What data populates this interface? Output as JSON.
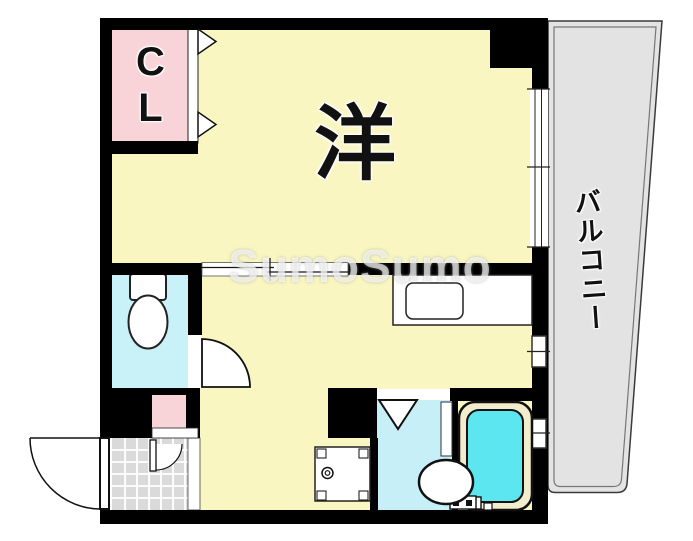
{
  "floorplan": {
    "labels": {
      "closet": "CL",
      "western_room": "洋",
      "balcony": "バルコニー"
    },
    "watermark": "SumoSumo",
    "colors": {
      "wall": "#000000",
      "room_yellow": "#FAF6C2",
      "closet_pink": "#F8D3D8",
      "toilet_cyan": "#C9F1F8",
      "washroom_cyan": "#C6EFF8",
      "tub_water": "#5BE6F0",
      "tub_rim": "#F2EDCD",
      "balcony_gray": "#E3E3E3",
      "entrance_tile": "#DADADA",
      "fixture_white": "#FFFFFF"
    }
  }
}
